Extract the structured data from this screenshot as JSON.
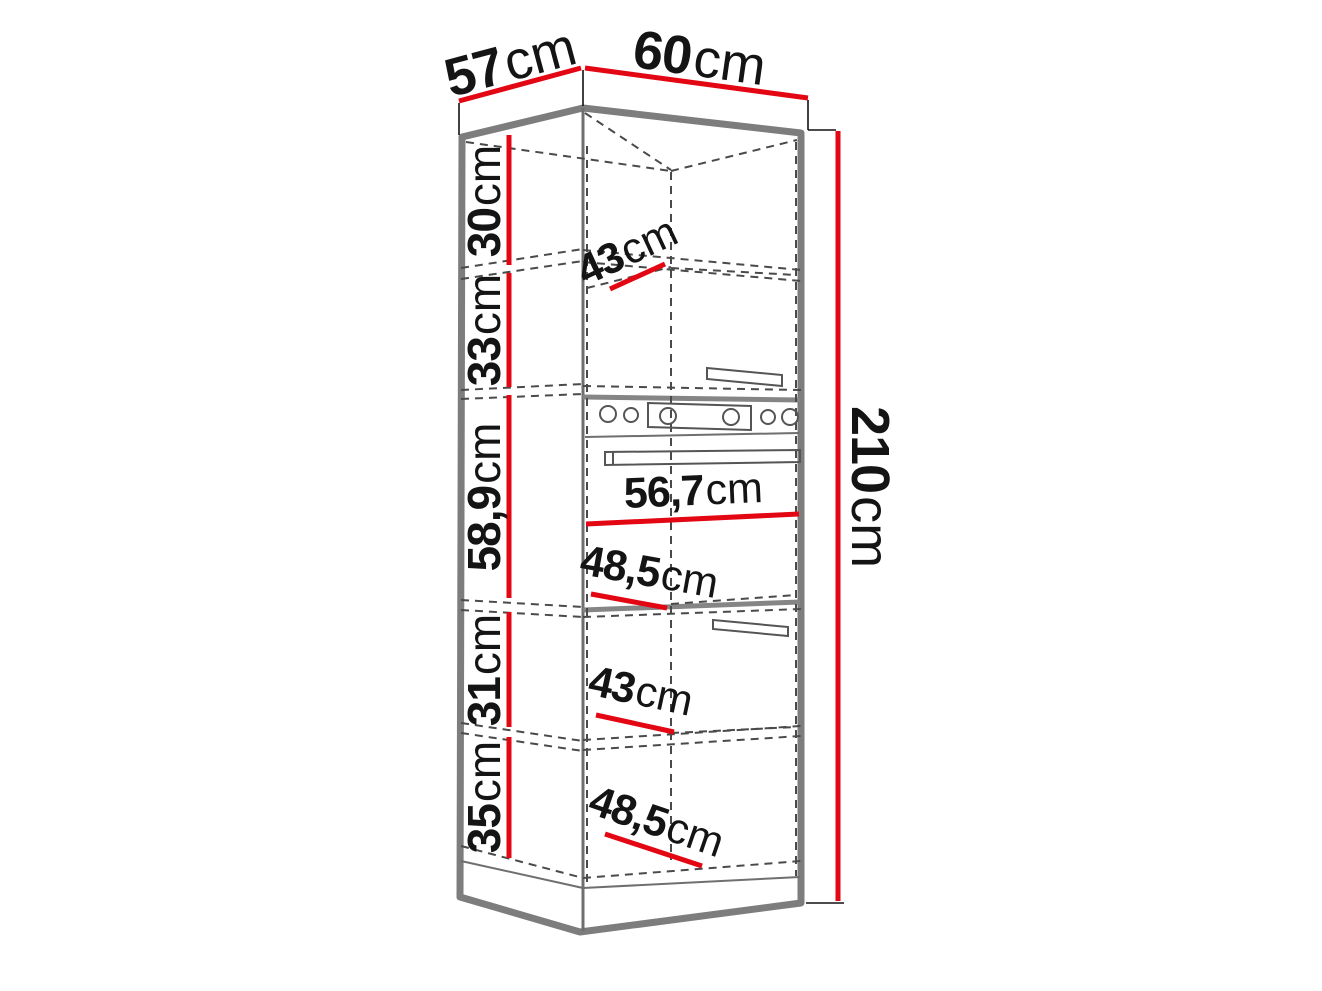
{
  "dims": {
    "top_depth": {
      "v": "57",
      "u": "cm"
    },
    "top_width": {
      "v": "60",
      "u": "cm"
    },
    "height": {
      "v": "210",
      "u": "cm"
    },
    "sections": [
      {
        "v": "30",
        "u": "cm"
      },
      {
        "v": "33",
        "u": "cm"
      },
      {
        "v": "58,9",
        "u": "cm"
      },
      {
        "v": "31",
        "u": "cm"
      },
      {
        "v": "35",
        "u": "cm"
      }
    ],
    "internal": [
      {
        "v": "43",
        "u": "cm"
      },
      {
        "v": "56,7",
        "u": "cm"
      },
      {
        "v": "48,5",
        "u": "cm"
      },
      {
        "v": "43",
        "u": "cm"
      },
      {
        "v": "48,5",
        "u": "cm"
      }
    ]
  },
  "colors": {
    "dimension_line": "#e30613",
    "outline": "#7d7d7d",
    "dashed": "#4a4a4a",
    "text": "#141414"
  }
}
